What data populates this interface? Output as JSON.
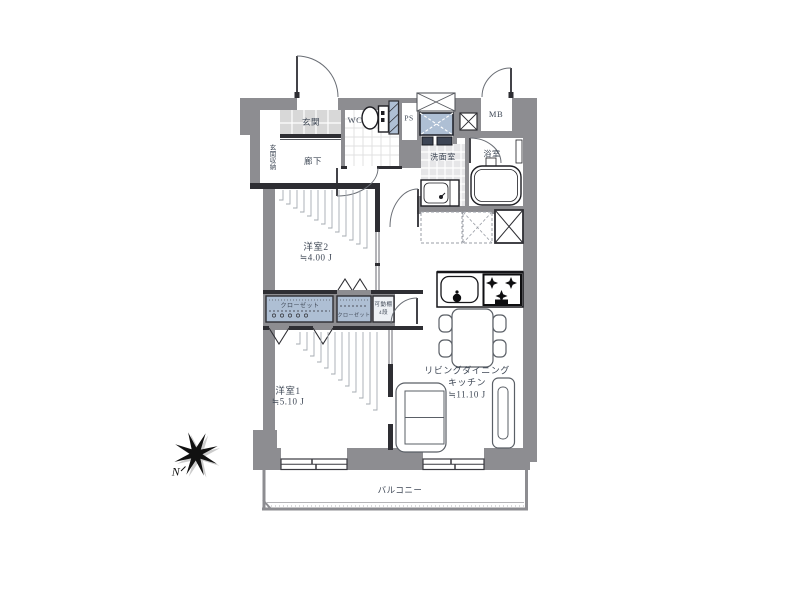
{
  "rooms": {
    "genkan": "玄関",
    "genkan_storage": "玄関収納",
    "hallway": "廊下",
    "wc": "WC",
    "ps": "PS",
    "mb": "MB",
    "washroom": "洗面室",
    "bathroom": "浴室",
    "bedroom2": {
      "name": "洋室2",
      "size": "≒4.00 J"
    },
    "bedroom1": {
      "name": "洋室1",
      "size": "≒5.10 J"
    },
    "ldk": {
      "name_line1": "リビングダイニング",
      "name_line2": "キッチン",
      "size": "≒11.10 J"
    },
    "balcony": "バルコニー"
  },
  "storage": {
    "closet_left": "クローゼット",
    "closet_middle": "クローゼット",
    "movable_shelf_line1": "可動棚",
    "movable_shelf_line2": "4段"
  },
  "compass": {
    "north": "N"
  },
  "colors": {
    "wall": "#8d8d91",
    "partition": "#2e2e33",
    "fixture_blue": "#aebfd4",
    "tile": "#d8d8d8",
    "floor": "#e6e6e8",
    "text": "#3f4856"
  }
}
